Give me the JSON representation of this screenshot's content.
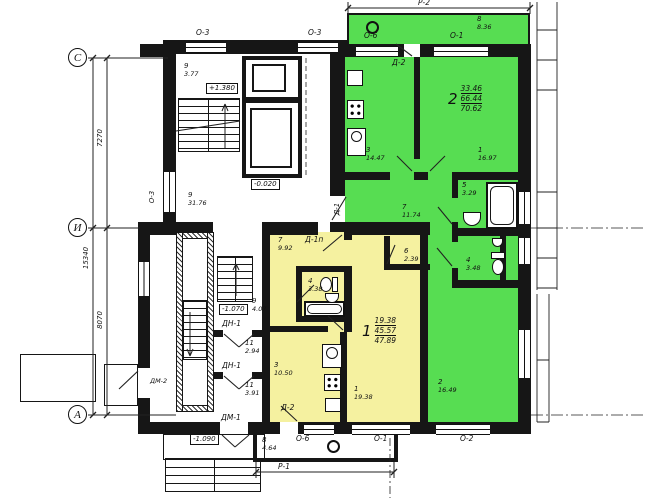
{
  "title": "Типовой этаж — план секции с квартирами 1 и 2",
  "colors": {
    "apartment1_fill": "#f5f1a0",
    "apartment2_fill": "#57dd52",
    "wall": "#161616"
  },
  "axes": {
    "c": "С",
    "i": "И",
    "a": "А"
  },
  "dims": {
    "upper": "7270",
    "total": "15340",
    "lower": "8070"
  },
  "levels": {
    "stair": "+1.380",
    "entry": "-0.020",
    "lower": "-1.070",
    "porch": "-1.090"
  },
  "marks": {
    "p2": "Р-2",
    "p1": "Р-1",
    "o3_top_left": "О-3",
    "o3_top_right": "О-3",
    "o3_left": "О-3",
    "o6_top": "О-6",
    "o1_top": "О-1",
    "o6_bottom": "О-6",
    "o1_bottom": "О-1",
    "o2_bottom": "О-2",
    "d2_top": "Д-2",
    "d2_bottom": "Д-2",
    "d1": "Д-1",
    "d1p": "Д-1п",
    "dn1_upper": "ДН-1",
    "dn1_lower": "ДН-1",
    "dm1": "ДМ-1",
    "dm2": "ДМ-2"
  },
  "apt2": {
    "num": "2",
    "living": "33.46",
    "total": "66.44",
    "full": "70.62"
  },
  "apt1": {
    "num": "1",
    "living": "19.38",
    "total": "45.57",
    "full": "47.89"
  },
  "rooms": {
    "stair_landing": {
      "n": "9",
      "a": "3.77"
    },
    "g_balcony": {
      "n": "8",
      "a": "8.36"
    },
    "g_kitchen": {
      "n": "3",
      "a": "14.47"
    },
    "g_room1": {
      "n": "1",
      "a": "16.97"
    },
    "g_bath": {
      "n": "5",
      "a": "3.29"
    },
    "g_hall": {
      "n": "7",
      "a": "11.74"
    },
    "g_wc": {
      "n": "4",
      "a": "3.48"
    },
    "g_room2": {
      "n": "2",
      "a": "16.49"
    },
    "corridor": {
      "n": "9",
      "a": "31.76"
    },
    "lower_landing": {
      "n": "9",
      "a": "4.07"
    },
    "vestibule1": {
      "n": "11",
      "a": "2.94"
    },
    "vestibule2": {
      "n": "11",
      "a": "3.91"
    },
    "y_hall": {
      "n": "7",
      "a": "9.92"
    },
    "y_bath": {
      "n": "4",
      "a": "3.38"
    },
    "y_closet": {
      "n": "6",
      "a": "2.39"
    },
    "y_kitchen": {
      "n": "3",
      "a": "10.50"
    },
    "y_living": {
      "n": "1",
      "a": "19.38"
    },
    "y_balcony": {
      "n": "8",
      "a": "4.64"
    }
  }
}
